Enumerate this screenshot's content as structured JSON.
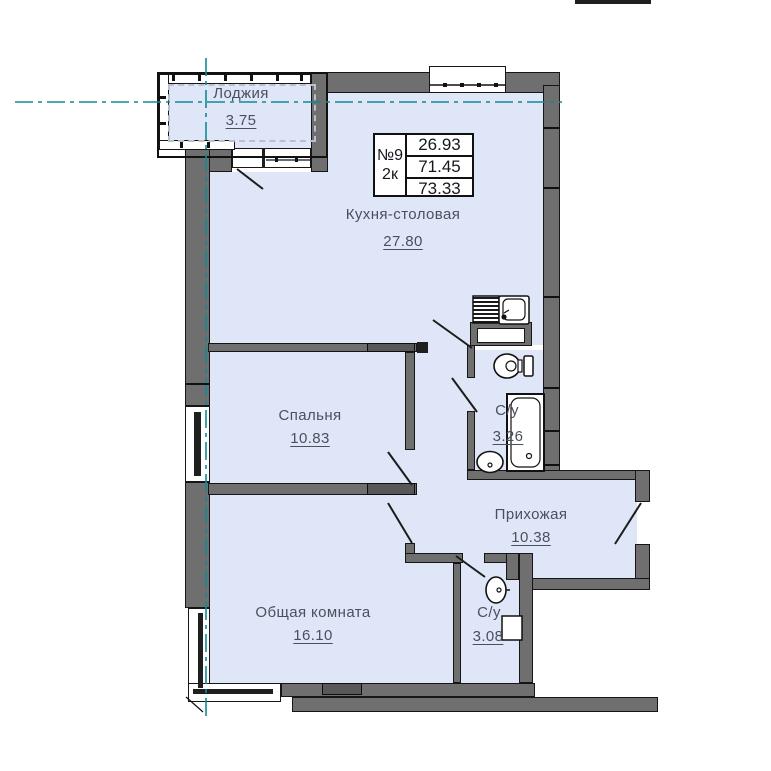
{
  "plan": {
    "description": "2-room apartment floor plan",
    "title_block": {
      "unit_number": "№9",
      "unit_type": "2к",
      "areas": [
        "26.93",
        "71.45",
        "73.33"
      ],
      "highlighted_area": "73.33",
      "highlight_color": "#ff2a2a"
    },
    "rooms": [
      {
        "name": "Лоджия",
        "area": "3.75"
      },
      {
        "name": "Кухня-столовая",
        "area": "27.80"
      },
      {
        "name": "Спальня",
        "area": "10.83"
      },
      {
        "name": "Общая комната",
        "area": "16.10"
      },
      {
        "name": "Прихожая",
        "area": "10.38"
      },
      {
        "name": "С/у",
        "area": "3.26"
      },
      {
        "name": "С/у",
        "area": "3.08"
      }
    ],
    "colors": {
      "room_fill": "#dfe6f7",
      "wall": "#6f6f6f",
      "centerline": "#0e8b96",
      "label_text": "#4b505e",
      "highlight_red": "#ff2a2a"
    }
  }
}
